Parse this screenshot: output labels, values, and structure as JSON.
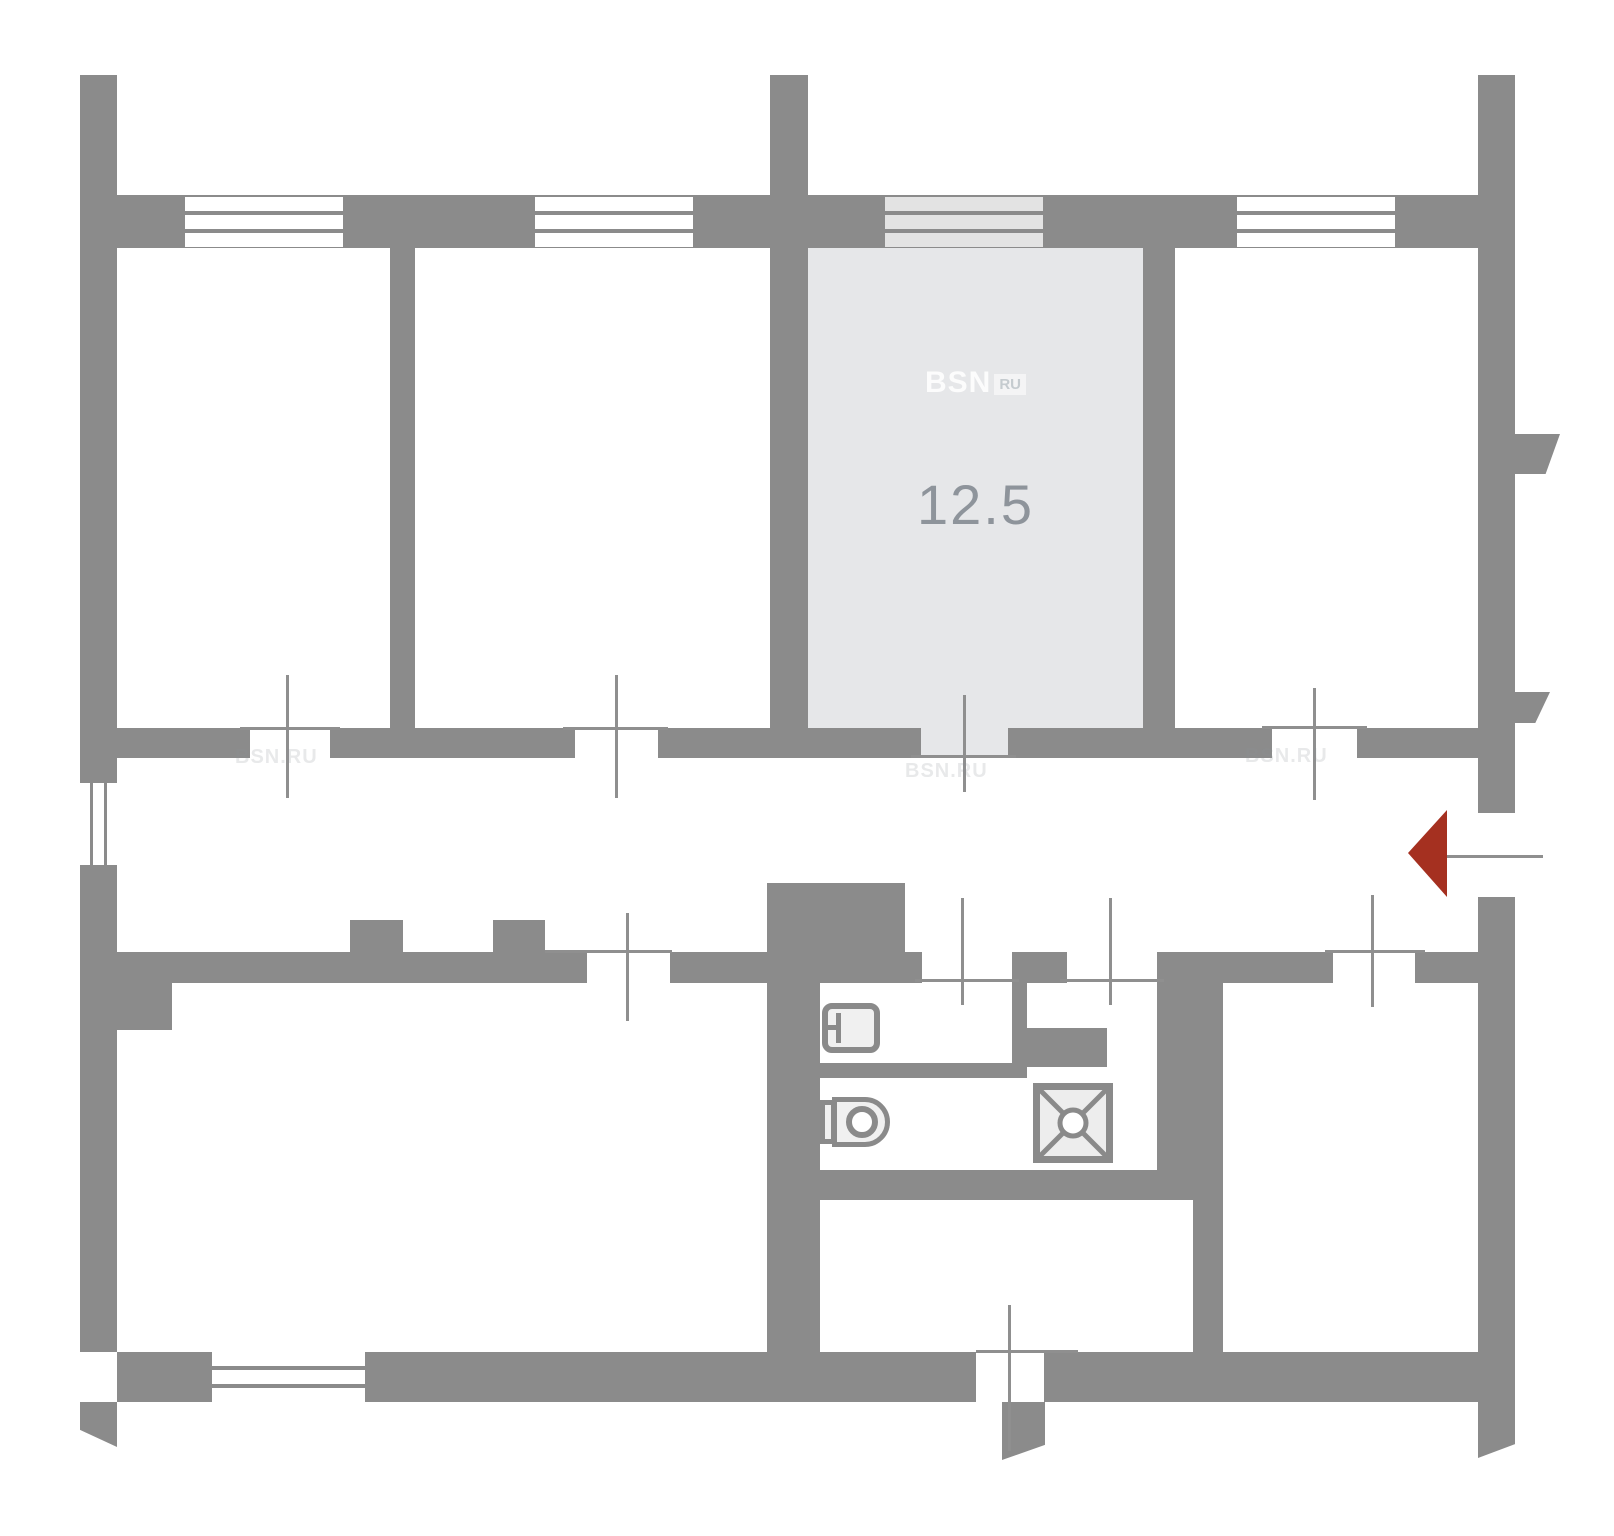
{
  "plan": {
    "highlighted_room": {
      "area_label": "12.5"
    },
    "watermark": {
      "brand": "BSN",
      "suffix": "RU",
      "tiled_text": "BSN.RU"
    },
    "colors": {
      "wall": "#8b8b8b",
      "line": "#8f8f8f",
      "highlight_fill": "#e6e7e9",
      "window_stripe": "#e3e3e3",
      "fixture_fill": "#f0f0f0",
      "fixture_stroke": "#8a8a8a",
      "arrow": "#a53020",
      "label_text": "#8e949b"
    }
  }
}
